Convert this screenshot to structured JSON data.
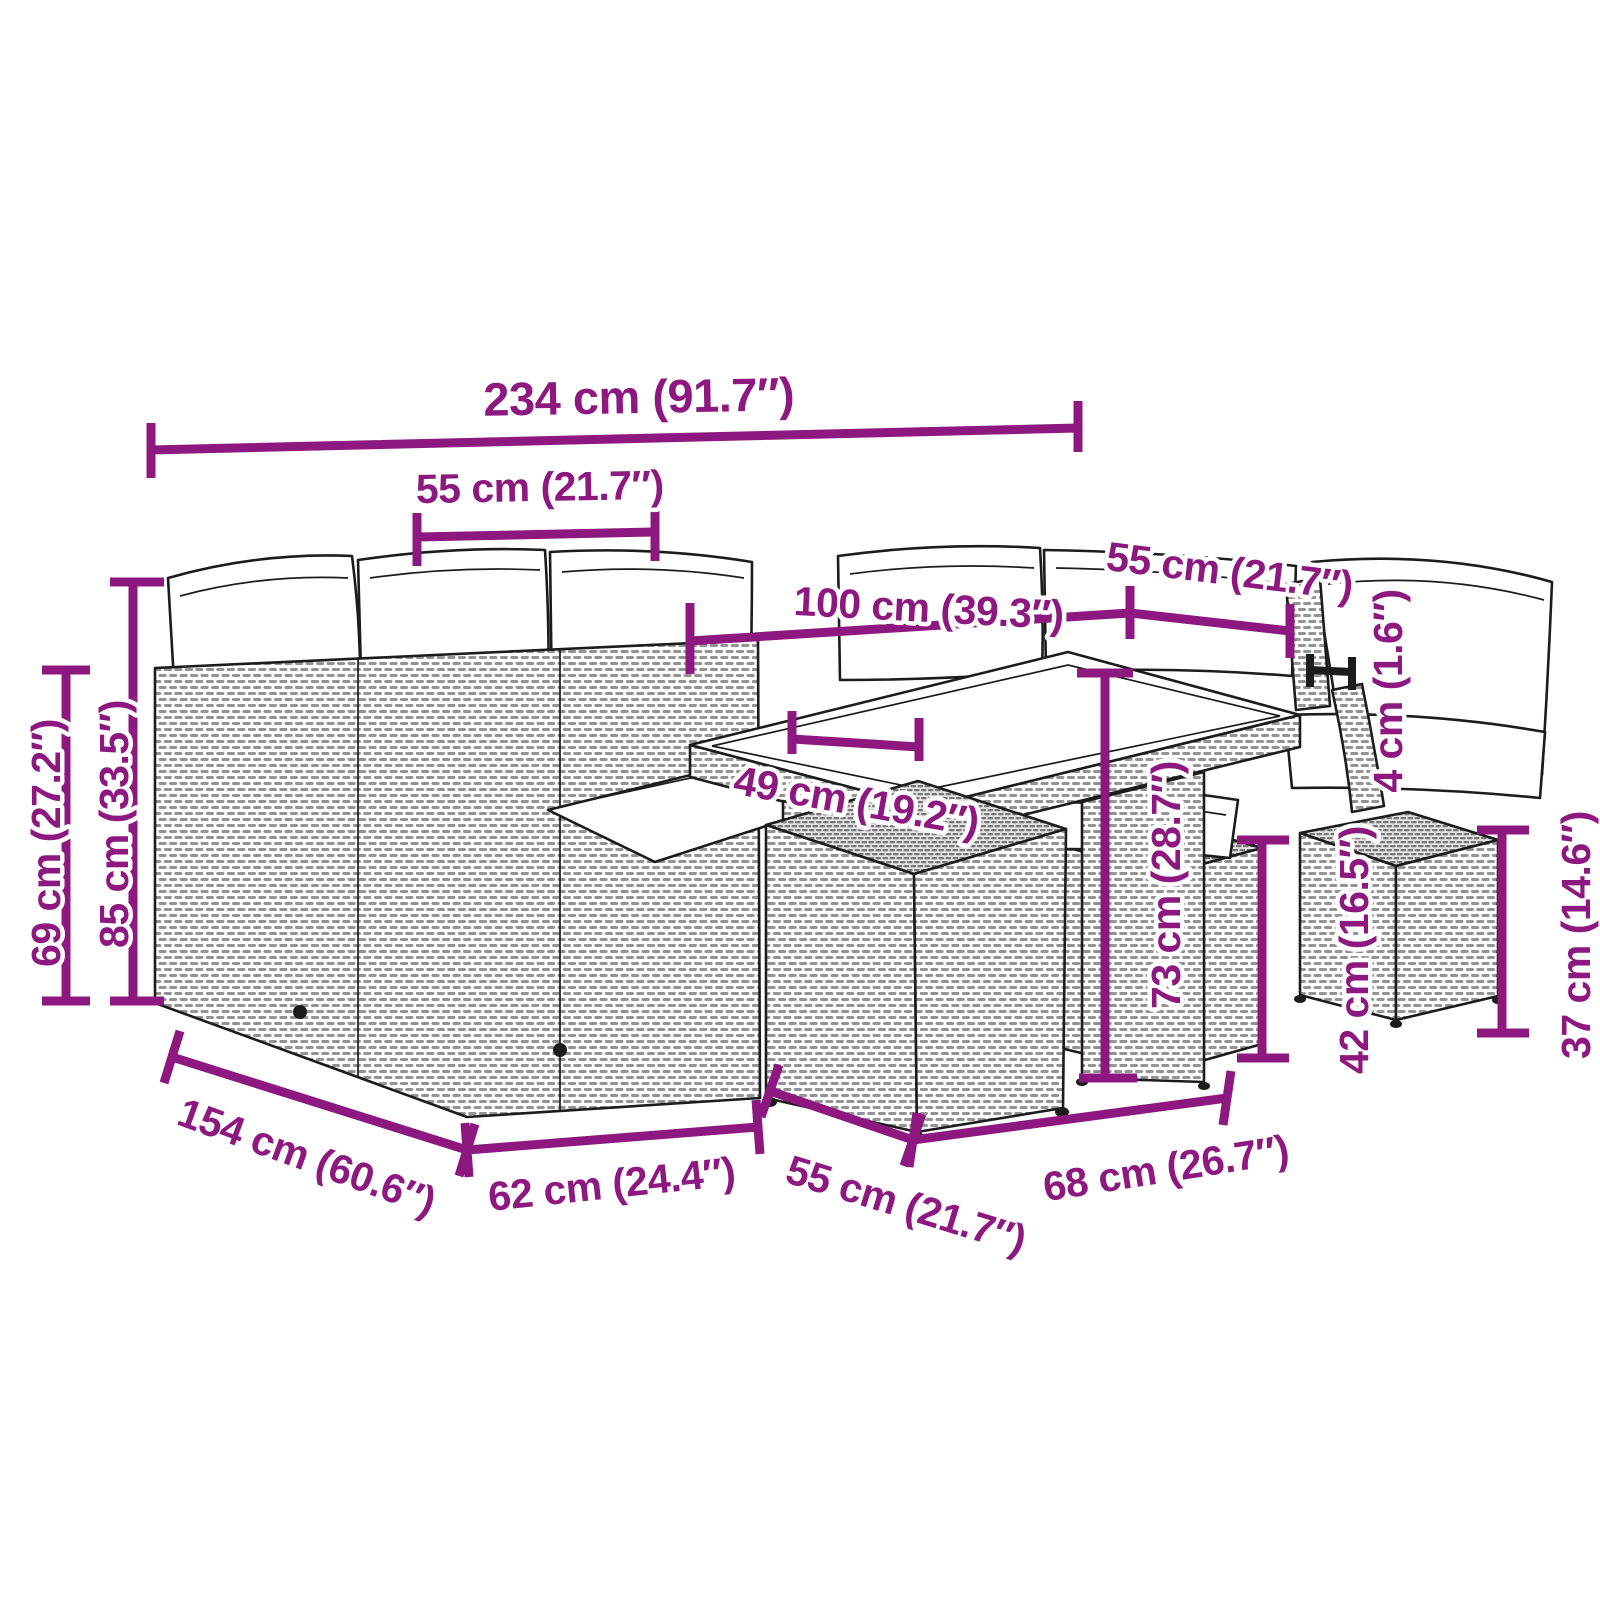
{
  "figure": {
    "kind": "furniture-dimension-diagram",
    "background": "#ffffff"
  },
  "colors": {
    "dimension": "#8d1980",
    "ink": "#1c1c1c"
  },
  "dims": {
    "overall_width": {
      "cm": 234,
      "inch": 91.7,
      "text": "234 cm (91.7″)"
    },
    "module_width_left": {
      "cm": 55,
      "inch": 21.7,
      "text": "55 cm (21.7″)"
    },
    "table_length": {
      "cm": 100,
      "inch": 39.3,
      "text": "100 cm (39.3″)"
    },
    "module_width_right": {
      "cm": 55,
      "inch": 21.7,
      "text": "55 cm (21.7″)"
    },
    "tabletop_thickness": {
      "cm": 4,
      "inch": 1.6,
      "text": "4 cm (1.6″)"
    },
    "table_height": {
      "cm": 73,
      "inch": 28.7,
      "text": "73 cm (28.7″)"
    },
    "table_inner_width": {
      "cm": 49,
      "inch": 19.2,
      "text": "49 cm (19.2″)"
    },
    "arm_height": {
      "cm": 69,
      "inch": 27.2,
      "text": "69 cm (27.2″)"
    },
    "back_height": {
      "cm": 85,
      "inch": 33.5,
      "text": "85 cm (33.5″)"
    },
    "overall_depth": {
      "cm": 154,
      "inch": 60.6,
      "text": "154 cm (60.6″)"
    },
    "module_depth": {
      "cm": 62,
      "inch": 24.4,
      "text": "62 cm (24.4″)"
    },
    "stool_width": {
      "cm": 55,
      "inch": 21.7,
      "text": "55 cm (21.7″)"
    },
    "stool_depth": {
      "cm": 68,
      "inch": 26.7,
      "text": "68 cm (26.7″)"
    },
    "stool_height": {
      "cm": 42,
      "inch": 16.5,
      "text": "42 cm (16.5″)"
    },
    "footstool_height": {
      "cm": 37,
      "inch": 14.6,
      "text": "37 cm (14.6″)"
    }
  }
}
